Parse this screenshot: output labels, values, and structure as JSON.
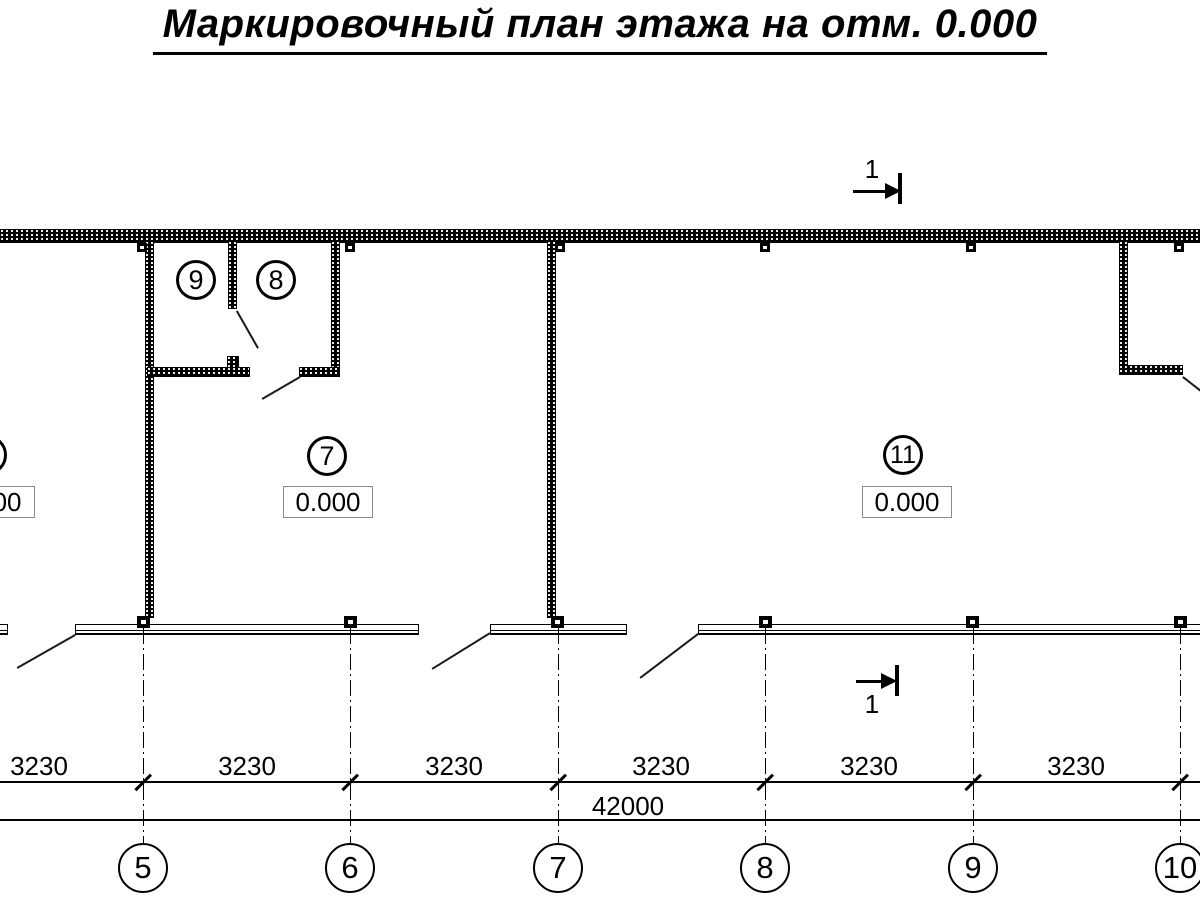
{
  "title": "Маркировочный план этажа на отм. 0.000",
  "rooms": {
    "room9": {
      "number": "9"
    },
    "room8": {
      "number": "8"
    },
    "room7": {
      "number": "7",
      "elevation": "0.000"
    },
    "room11": {
      "number": "11",
      "elevation": "0.000"
    },
    "left_partial": {
      "elevation": "0.000"
    }
  },
  "section_marks": {
    "upper": "1",
    "lower": "1"
  },
  "dimensions": {
    "row1": [
      {
        "label": "3230"
      },
      {
        "label": "3230"
      },
      {
        "label": "3230"
      },
      {
        "label": "3230"
      },
      {
        "label": "3230"
      },
      {
        "label": "3230"
      }
    ],
    "total": "42000"
  },
  "grid": {
    "bubbles": [
      {
        "label": "5"
      },
      {
        "label": "6"
      },
      {
        "label": "7"
      },
      {
        "label": "8"
      },
      {
        "label": "9"
      },
      {
        "label": "10"
      }
    ]
  }
}
